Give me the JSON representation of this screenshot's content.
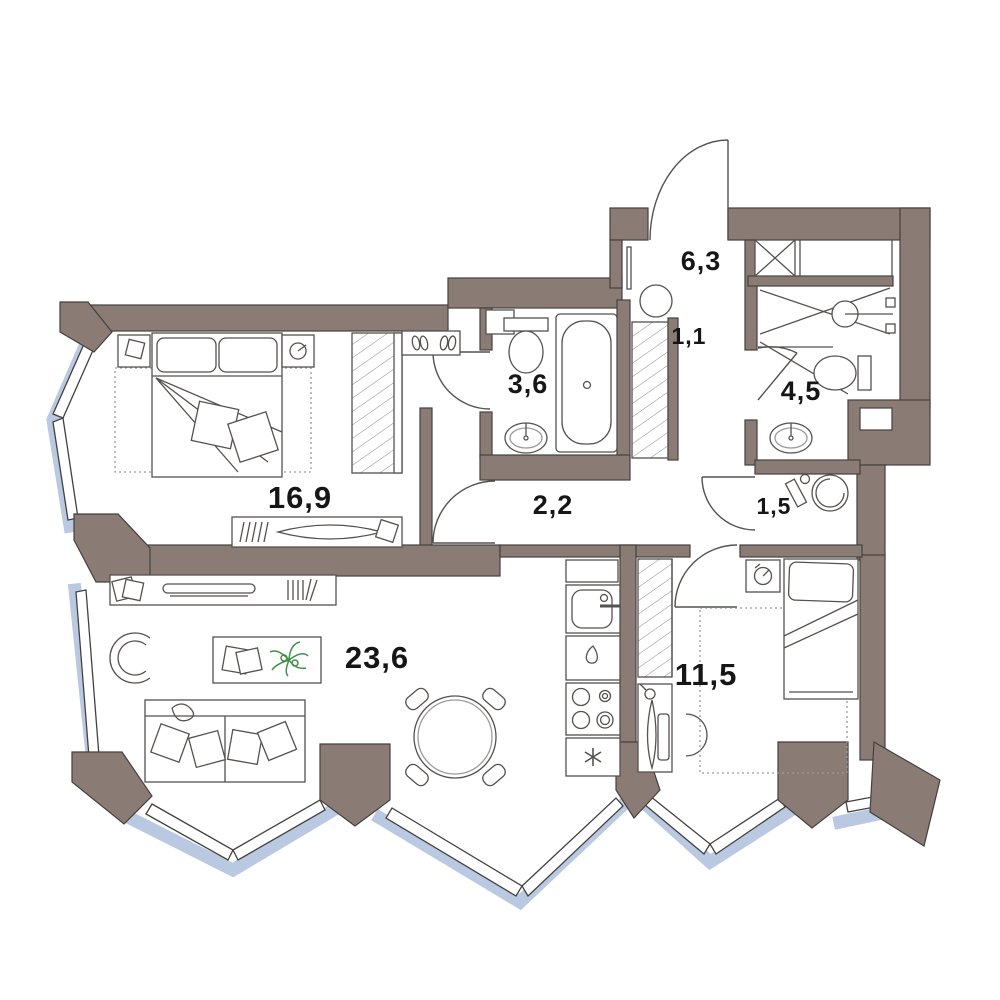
{
  "plan": {
    "type": "apartment-floor-plan",
    "rooms": [
      {
        "id": "hallway",
        "area_label": "6,3"
      },
      {
        "id": "closet",
        "area_label": "1,1"
      },
      {
        "id": "shower-room",
        "area_label": "4,5"
      },
      {
        "id": "bathroom",
        "area_label": "3,6"
      },
      {
        "id": "corridor",
        "area_label": "2,2"
      },
      {
        "id": "laundry",
        "area_label": "1,5"
      },
      {
        "id": "bedroom",
        "area_label": "16,9"
      },
      {
        "id": "living-room",
        "area_label": "23,6"
      },
      {
        "id": "bedroom-2",
        "area_label": "11,5"
      }
    ],
    "colors": {
      "wall": "#8a7c75",
      "wall_outline": "#44403d",
      "glazing": "#b9c9e1",
      "furniture_line": "#55514e",
      "plant": "#3f8f46",
      "floor": "#ffffff",
      "label_text": "#161616"
    }
  }
}
